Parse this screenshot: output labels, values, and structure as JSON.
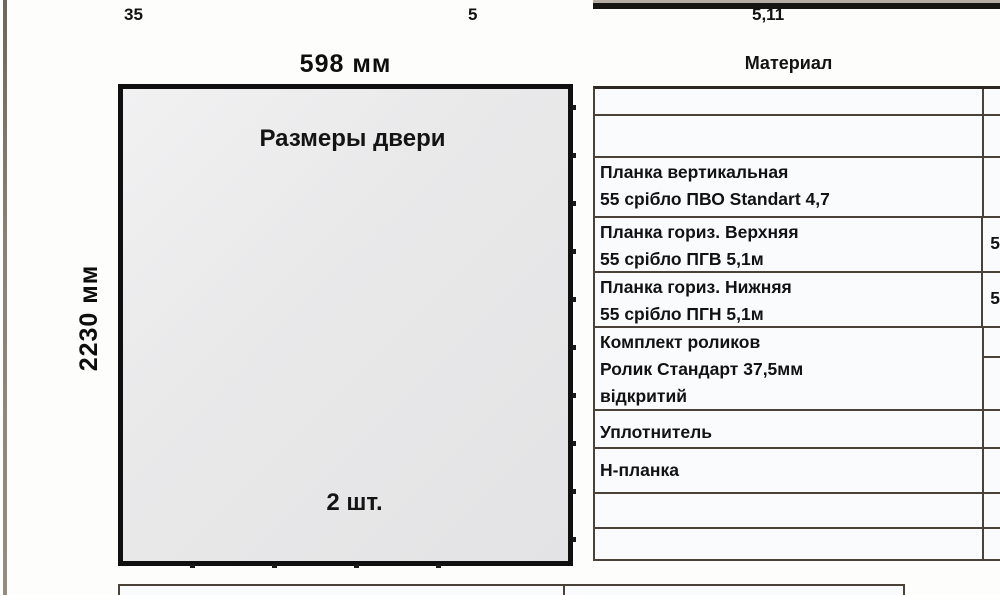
{
  "door_diagram": {
    "width_label": "598 мм",
    "height_label": "2230 мм",
    "title": "Размеры двери",
    "count_label": "2 шт."
  },
  "materials_table": {
    "header": "Материал",
    "rows": [
      {
        "name": "",
        "value": ""
      },
      {
        "name": "",
        "value": ""
      },
      {
        "name": "Планка вертикальная\n55 срібло ПВО Standart 4,7",
        "value": ""
      },
      {
        "name": "Планка гориз. Верхняя\n55 срібло ПГВ 5,1м",
        "value": "5"
      },
      {
        "name": "Планка гориз. Нижняя\n55 срібло ПГН 5,1м",
        "value": "5"
      },
      {
        "name": "Комплект роликов\nРолик Стандарт 37,5мм\nвідкритий",
        "value": ""
      },
      {
        "name": "Уплотнитель",
        "value": ""
      },
      {
        "name": "Н-планка",
        "value": ""
      },
      {
        "name": "",
        "value": ""
      },
      {
        "name": "",
        "value": ""
      }
    ]
  },
  "bottom_table": {
    "cells": [
      "35",
      "5",
      "5,11"
    ]
  },
  "colors": {
    "table_border": "#4a4138",
    "door_border": "#101010",
    "door_fill": "#e9e9ea",
    "cell_background": "#fafbfd"
  }
}
